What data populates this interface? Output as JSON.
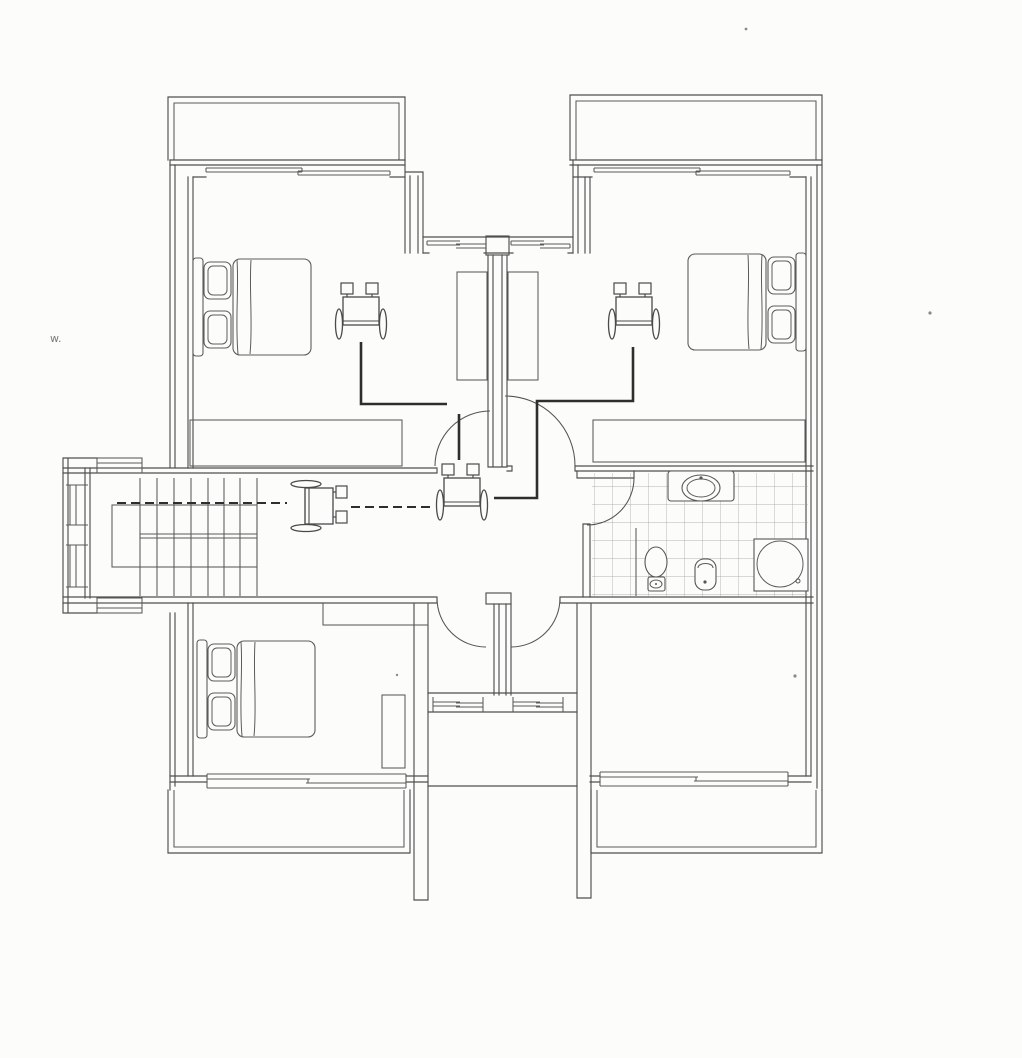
{
  "document": {
    "type": "scanned architectural floor plan",
    "description": "black-line upper-floor plan with three bedrooms, central hall, bathroom, staircase, four balconies and wheelchair accessibility symbols",
    "paper_color": "#fcfcfa",
    "ink_color": "#4f4f4f",
    "route_color": "#2e2e2e",
    "visible_text": "none (drawing only)"
  },
  "rooms": [
    {
      "id": "bedroom-top-left",
      "contents": [
        "double-bed",
        "wheelchair-symbol",
        "built-in-wardrobe-top",
        "built-in-wardrobe-bottom",
        "window",
        "balcony-access"
      ]
    },
    {
      "id": "bedroom-top-right",
      "contents": [
        "double-bed",
        "wheelchair-symbol",
        "built-in-wardrobe-top",
        "built-in-wardrobe-bottom",
        "window",
        "balcony-access"
      ]
    },
    {
      "id": "bedroom-bottom-left",
      "contents": [
        "double-bed",
        "wardrobe",
        "shelf-unit",
        "window",
        "balcony-access"
      ]
    },
    {
      "id": "room-bottom-right",
      "contents": [
        "window",
        "balcony-access"
      ]
    },
    {
      "id": "bathroom",
      "floor": "tiled",
      "fixtures": [
        "washbasin",
        "toilet",
        "bidet",
        "shower"
      ]
    },
    {
      "id": "staircase",
      "contents": [
        "treads",
        "landing-void",
        "wheelchair-symbol",
        "side-windows"
      ]
    },
    {
      "id": "central-hall",
      "contents": [
        "wheelchair-symbol",
        "door-swings"
      ]
    },
    {
      "id": "lower-shaft",
      "contents": [
        "window-band",
        "stair-shaft-walls"
      ]
    }
  ],
  "symbols": {
    "wheelchair_count": 4,
    "door_swing_arcs": 5,
    "beds": 3,
    "balconies": 4,
    "window_bands": 10
  },
  "accessible_routes": {
    "solid_segments": 3,
    "dashed_segments": 2,
    "note": "dark lines connecting wheelchair symbols through hall and corridor"
  },
  "bathroom_fixtures": [
    "washbasin",
    "toilet",
    "bidet",
    "shower"
  ],
  "artifacts": {
    "handwriting_mark": "w.",
    "specks": 4
  }
}
